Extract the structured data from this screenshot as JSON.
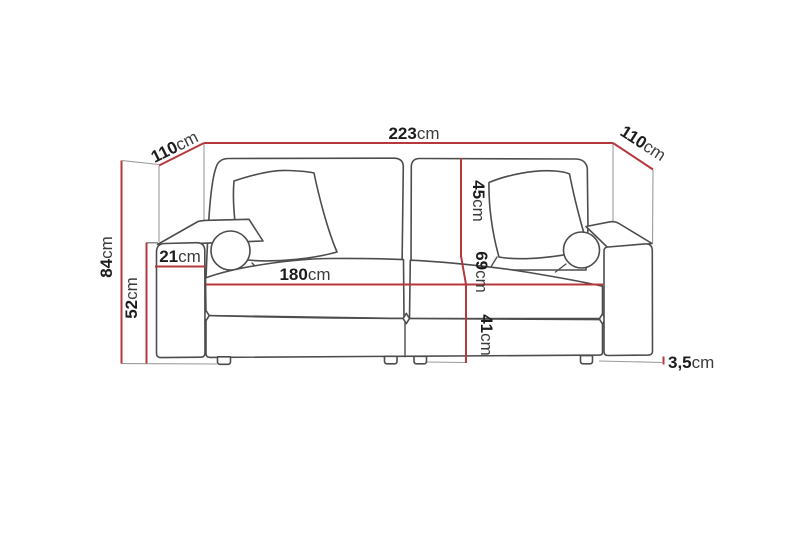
{
  "page": {
    "background": "#ffffff",
    "description_label": "sofa-dimension-diagram"
  },
  "colors": {
    "dimension_line": "#b5383d",
    "sofa_outline": "#4d4d4d",
    "extension_line": "#9b9b9b",
    "label_number": "#1c1c1c",
    "label_unit": "#3c3c3c"
  },
  "diagram": {
    "type": "furniture-dimension-drawing",
    "unit": "cm",
    "measurements": {
      "overall_width": {
        "value": "223",
        "unit": "cm"
      },
      "depth_left": {
        "value": "110",
        "unit": "cm"
      },
      "depth_right": {
        "value": "110",
        "unit": "cm"
      },
      "overall_height": {
        "value": "84",
        "unit": "cm"
      },
      "armrest_height": {
        "value": "52",
        "unit": "cm"
      },
      "armrest_width": {
        "value": "21",
        "unit": "cm"
      },
      "seat_width": {
        "value": "180",
        "unit": "cm"
      },
      "backrest_height": {
        "value": "45",
        "unit": "cm"
      },
      "seat_depth": {
        "value": "69",
        "unit": "cm"
      },
      "seat_height": {
        "value": "41",
        "unit": "cm"
      },
      "leg_height": {
        "value": "3,5",
        "unit": "cm"
      }
    }
  }
}
